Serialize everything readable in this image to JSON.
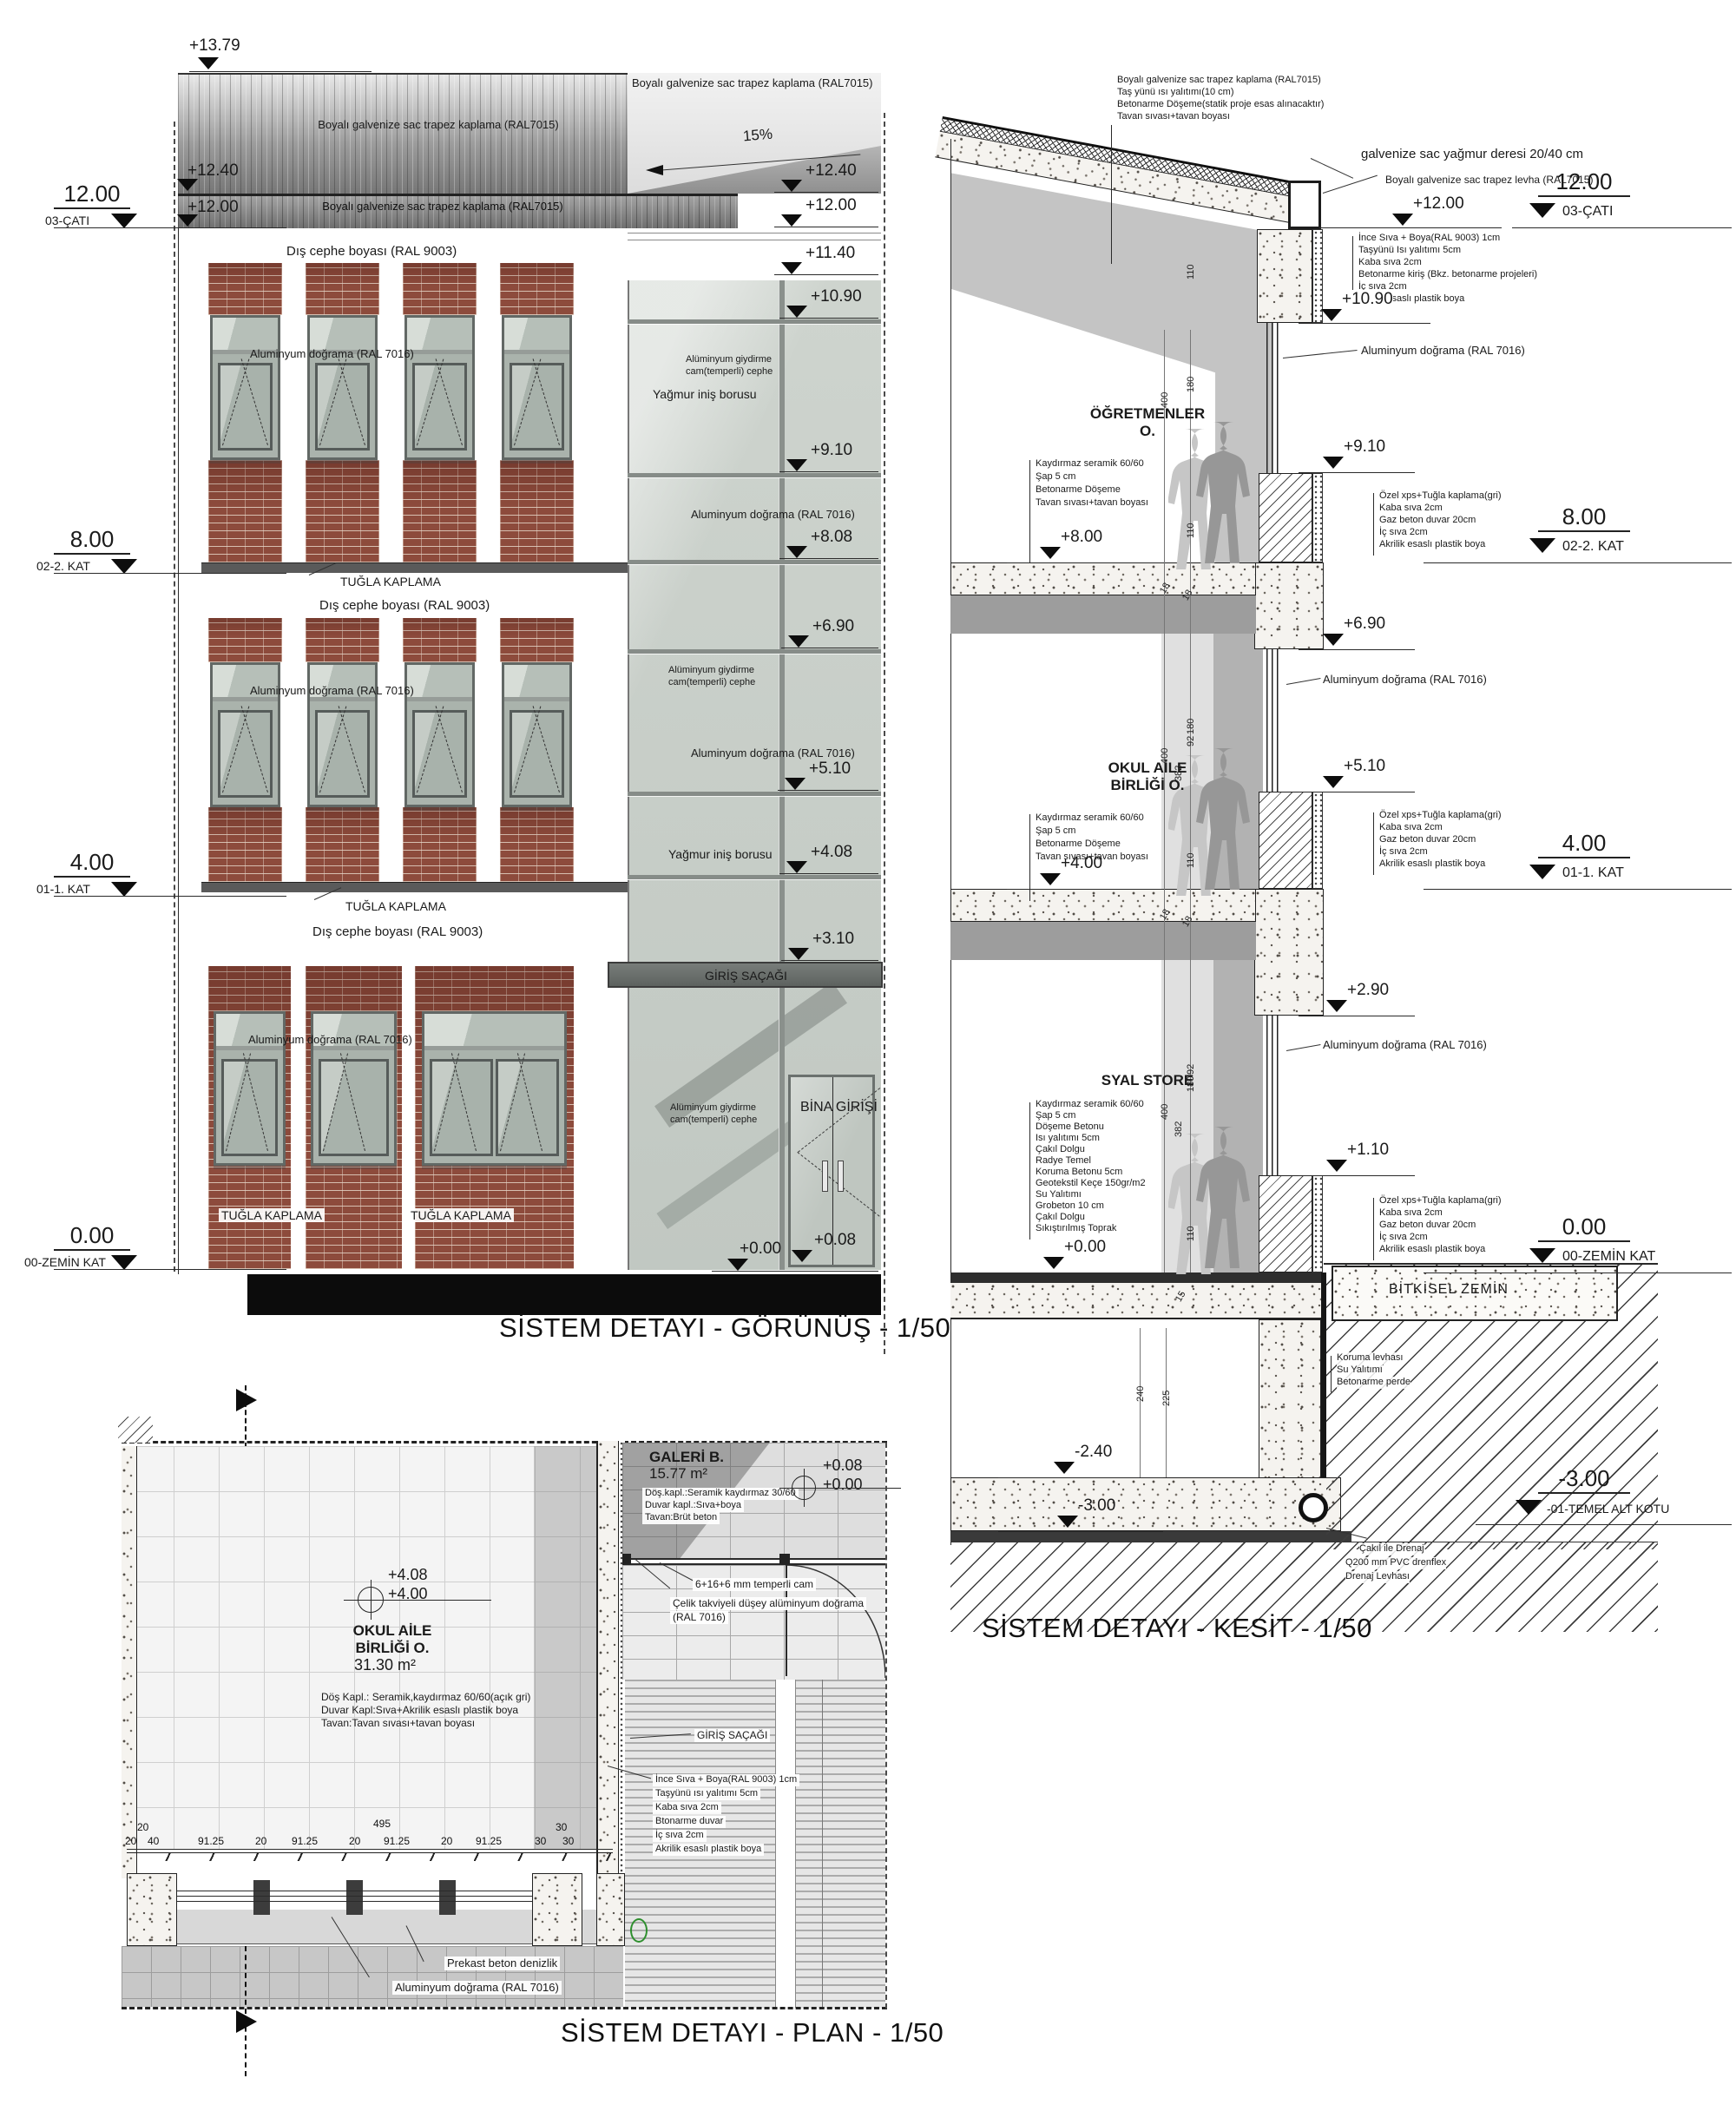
{
  "colors": {
    "brick": "#8d4b3c",
    "curtain_glass": "#cbd2cc",
    "metal_roof": "#8f8f8f",
    "slab_dark": "#4c4c4c",
    "person_gray": "#979797",
    "marker_green": "#2e8f2e",
    "line": "#1a1a1a"
  },
  "elevation": {
    "title": "SİSTEM DETAYI - GÖRÜNÜŞ - 1/50",
    "slope_label": "15%",
    "mark_top": "+13.79",
    "marks_left": [
      "+12.40",
      "+12.00"
    ],
    "levels_left": [
      {
        "value": "12.00",
        "label": "03-ÇATI"
      },
      {
        "value": "8.00",
        "label": "02-2. KAT"
      },
      {
        "value": "4.00",
        "label": "01-1. KAT"
      },
      {
        "value": "0.00",
        "label": "00-ZEMİN KAT"
      }
    ],
    "marks_right": [
      "+12.40",
      "+12.00",
      "+11.40",
      "+10.90",
      "+9.10",
      "+8.08",
      "+6.90",
      "+5.10",
      "+4.08",
      "+3.10"
    ],
    "entry_marks": {
      "inner": "+0.00",
      "outer": "+0.08"
    },
    "roof_label": "Boyalı galvenize sac trapez kaplama (RAL7015)",
    "facade_paint_label": "Dış cephe boyası (RAL 9003)",
    "alum_label": "Aluminyum doğrama (RAL 7016)",
    "brick_label": "TUĞLA KAPLAMA",
    "curtain_label": [
      "Alüminyum giydirme",
      "cam(temperli) cephe"
    ],
    "rain_pipe_label": "Yağmur iniş borusu",
    "canopy_label": "GİRİŞ SAÇAĞI",
    "entrance_label": "BİNA GİRİŞİ"
  },
  "section": {
    "title": "SİSTEM DETAYI - KESİT - 1/50",
    "roof_layers": [
      "Boyalı galvenize sac trapez kaplama (RAL7015)",
      "Taş yünü ısı yalıtımı(10 cm)",
      "Betonarme Döşeme(statik proje esas alınacaktır)",
      "Tavan sıvası+tavan boyası"
    ],
    "gutter_label": "galvenize sac yağmur deresi 20/40 cm",
    "roof_sheet_label": "Boyalı galvenize sac trapez levha (RAL7015)",
    "parapet_layers": [
      "İnce Sıva + Boya(RAL 9003) 1cm",
      "Taşyünü Isı yalıtımı 5cm",
      "Kaba sıva 2cm",
      "Betonarme kiriş (Bkz. betonarme projeleri)",
      "İç sıva 2cm",
      "Akrilik esaslı plastik boya"
    ],
    "wall_layers": [
      "Özel xps+Tuğla kaplama(gri)",
      "Kaba sıva 2cm",
      "Gaz beton duvar 20cm",
      "İç sıva 2cm",
      "Akrilik esaslı plastik boya"
    ],
    "alum_label": "Aluminyum doğrama (RAL 7016)",
    "marks": [
      "+12.00",
      "+10.90",
      "+9.10",
      "+8.00",
      "+6.90",
      "+5.10",
      "+4.00",
      "+2.90",
      "+1.10",
      "+0.00",
      "-2.40",
      "-3.00"
    ],
    "levels_right": [
      {
        "value": "12.00",
        "label": "03-ÇATI"
      },
      {
        "value": "8.00",
        "label": "02-2. KAT"
      },
      {
        "value": "4.00",
        "label": "01-1. KAT"
      },
      {
        "value": "0.00",
        "label": "00-ZEMİN KAT"
      },
      {
        "value": "-3.00",
        "label": "-01-TEMEL ALT KOTU"
      }
    ],
    "rooms": [
      {
        "name": "ÖĞRETMENLER",
        "name2": "O.",
        "layers": [
          "Kaydırmaz seramik 60/60",
          "Şap 5 cm",
          "Betonarme Döşeme",
          "Tavan sıvası+tavan boyası"
        ]
      },
      {
        "name": "OKUL AİLE",
        "name2": "BİRLİĞİ O.",
        "layers": [
          "Kaydırmaz seramik 60/60",
          "Şap 5 cm",
          "Betonarme Döşeme",
          "Tavan sıvası+tavan boyası"
        ]
      },
      {
        "name": "SYAL STORE",
        "name2": "",
        "layers": [
          "Kaydırmaz seramik 60/60",
          "Şap 5 cm",
          "Döşeme Betonu",
          "Isı yalıtımı 5cm",
          "Çakıl Dolgu",
          "Radye Temel",
          "Koruma Betonu 5cm",
          "Geotekstil Keçe 150gr/m2",
          "Su Yalıtımı",
          "Grobeton 10 cm",
          "Çakıl Dolgu",
          "Sıkıştırılmış Toprak"
        ]
      }
    ],
    "ground_label": "BİTKİSEL ZEMİN",
    "basement_wall_layers": [
      "Koruma levhası",
      "Su Yalıtımı",
      "Betonarme perde"
    ],
    "drain_labels": [
      "Çakıl ile Drenaj",
      "Q200 mm PVC drenflex",
      "Drenaj Levhası"
    ],
    "dims": {
      "roof": "110",
      "f2": [
        "400",
        "180",
        "110",
        "18",
        "18",
        "92"
      ],
      "f1": [
        "400",
        "382",
        "180",
        "110",
        "18",
        "18",
        "92"
      ],
      "f0": [
        "400",
        "382",
        "180",
        "110",
        "15"
      ],
      "base": [
        "240",
        "225"
      ]
    }
  },
  "plan": {
    "title": "SİSTEM DETAYI - PLAN - 1/50",
    "galeri": {
      "name": "GALERİ B.",
      "area": "15.77 m²",
      "level_top": "+0.08",
      "level_bottom": "+0.00",
      "layers": [
        "Döş.kapl.:Seramik kaydırmaz 30/60",
        "Duvar kapl.:Sıva+boya",
        "Tavan:Brüt beton"
      ]
    },
    "room": {
      "name": "OKUL AİLE",
      "name2": "BİRLİĞİ O.",
      "area": "31.30 m²",
      "level_top": "+4.08",
      "level_bottom": "+4.00",
      "layers": [
        "Döş Kapl.: Seramik,kaydırmaz 60/60(açık gri)",
        "Duvar Kapl:Sıva+Akrilik esaslı plastik boya",
        "Tavan:Tavan sıvası+tavan boyası"
      ]
    },
    "glass_label": "6+16+6 mm temperli cam",
    "steel_frame_label": [
      "Çelik takviyeli düşey alüminyum doğrama",
      "(RAL 7016)"
    ],
    "canopy_label": "GİRİŞ SAÇAĞI",
    "wall_layers": [
      "İnce Sıva + Boya(RAL 9003) 1cm",
      "Taşyünü ısı yalıtımı 5cm",
      "Kaba sıva 2cm",
      "Btonarme duvar",
      "İç sıva 2cm",
      "Akrilik esaslı plastik boya"
    ],
    "sill_label": "Prekast beton denizlik",
    "alum_label": "Aluminyum doğrama (RAL 7016)",
    "dims_upper": [
      "20",
      "495",
      "30"
    ],
    "dims": [
      "20",
      "40",
      "91.25",
      "20",
      "91.25",
      "20",
      "91.25",
      "20",
      "91.25",
      "30",
      "30"
    ]
  }
}
